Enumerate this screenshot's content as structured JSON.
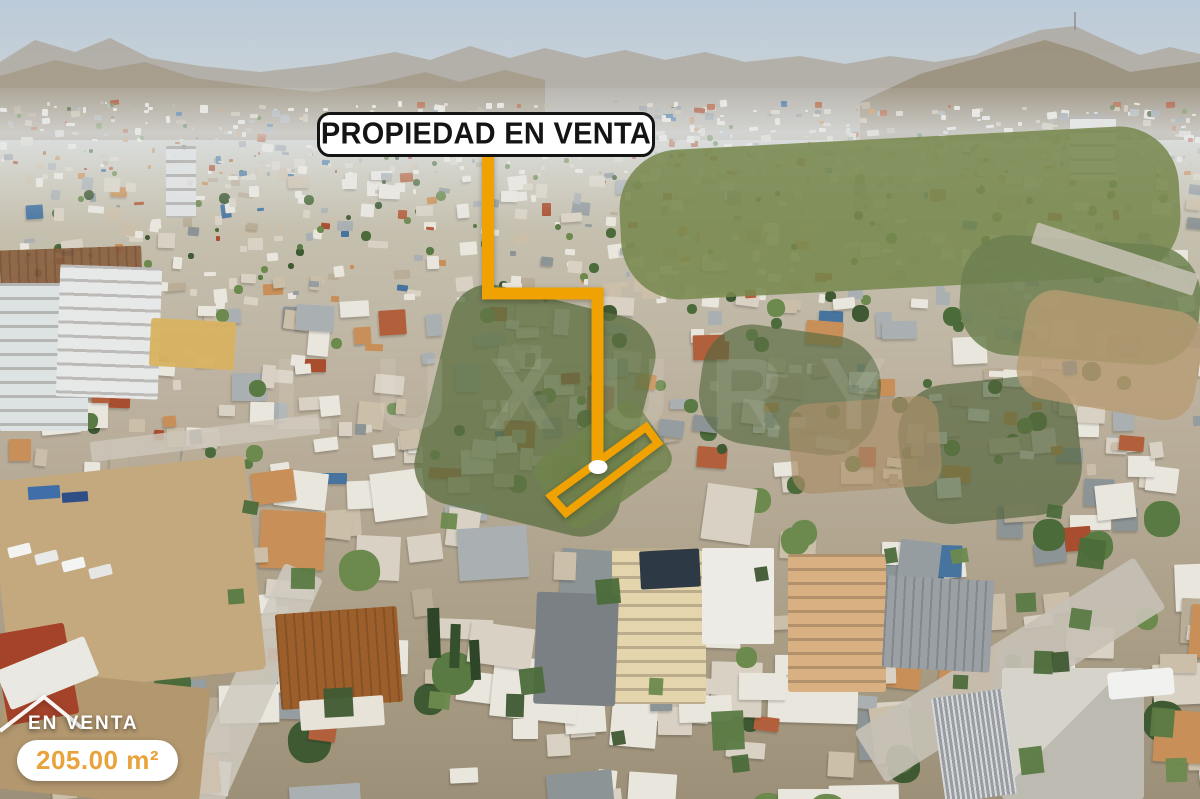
{
  "annotation": {
    "label": "PROPIEDAD EN VENTA"
  },
  "badge": {
    "status": "EN VENTA",
    "area": "205.00 m²"
  },
  "watermark": {
    "text": "LUXURY"
  },
  "colors": {
    "accent": "#F0A202",
    "area_text": "#E8A33C",
    "label_text": "#141414",
    "label_border": "#141414",
    "label_bg": "#FFFFFF",
    "status_text": "#FFFFFF",
    "marker_dot": "#FFFFFF"
  }
}
